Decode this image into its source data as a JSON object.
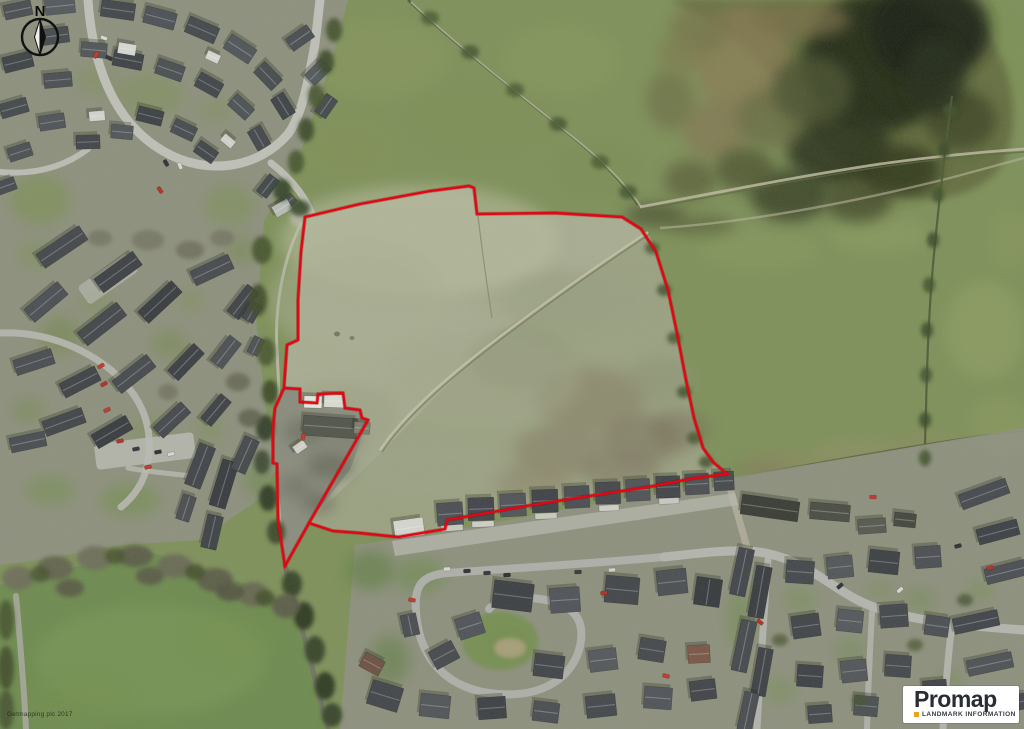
{
  "window": {
    "width": 1024,
    "height": 729
  },
  "map": {
    "type": "aerial-photograph",
    "description": "Aerial site plan with red property boundary",
    "base_color": "#7f915b"
  },
  "compass": {
    "label": "N",
    "color": "#121212"
  },
  "boundary": {
    "color": "#e30613",
    "underlay_color": "#8c0000",
    "stroke_width": 2.4,
    "main_points": "305,217 360,204 430,191 469,186 474,188 477,214 555,213 622,217 641,229 656,252 668,290 677,333 686,380 694,418 703,448 713,462 727,474 695,478 648,487 570,499 532,505 447,520 445,529 398,537 360,533 333,531 309,523 285,566 278,520 277,464 273,463 273,428 275,408 284,388 287,345 298,340 298,300 301,252",
    "spur_points": "284,388 300,389 300,402 317,403 318,394 343,393 345,408 360,410 362,418 368,420 309,523"
  },
  "logo": {
    "title": "Promap",
    "subtitle": "LANDMARK INFORMATION",
    "bullet_color": "#eda41c",
    "bg": "#ffffff",
    "title_color": "#292d33",
    "subtitle_color": "#34383d"
  },
  "copyright": {
    "text": "Getmapping plc 2017"
  }
}
